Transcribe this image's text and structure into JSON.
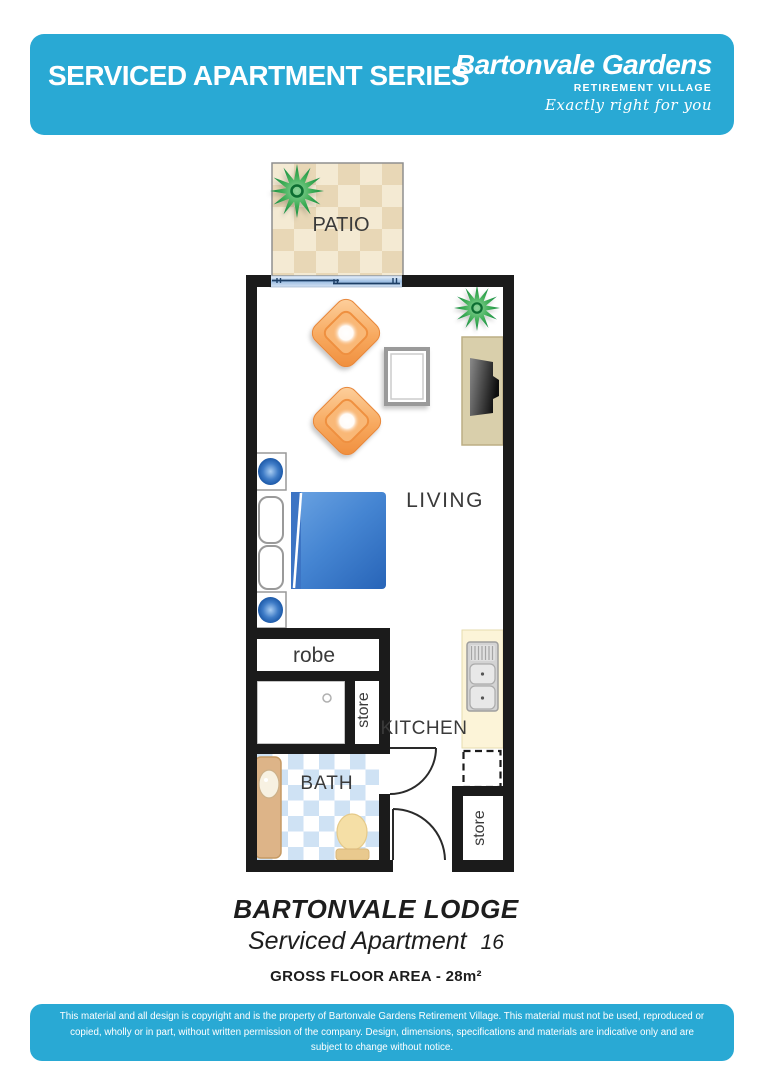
{
  "header": {
    "title": "SERVICED APARTMENT SERIES",
    "brand": "Bartonvale Gardens",
    "brand_sub": "RETIREMENT VILLAGE",
    "tagline": "Exactly right for you"
  },
  "plan": {
    "labels": {
      "patio": "PATIO",
      "living": "LIVING",
      "robe": "robe",
      "store_upper": "store",
      "kitchen": "KITCHEN",
      "bath": "BATH",
      "store_lower": "store"
    },
    "icons": [
      "plant-icon",
      "sliding-door",
      "armchair-icon",
      "coffee-table-icon",
      "tv-cabinet-icon",
      "bedside-lamp-icon",
      "pillow-icon",
      "bed-icon",
      "kitchen-sink-icon",
      "appliance-provision-dashed",
      "vanity-basin-icon",
      "toilet-icon",
      "door-swing-arc"
    ],
    "colors": {
      "accent_blue": "#29a9d4",
      "wall": "#1b1b1b",
      "patio_tan": "#e8d7b6",
      "patio_cream": "#f4ead3",
      "bath_tile_blue": "#cfe2f4",
      "chair_orange": "#f5a055",
      "bed_blue": "#3d7fcb",
      "bench_cream": "#fcf4d8",
      "plant_green": "#1f9348"
    }
  },
  "titles": {
    "lodge": "BARTONVALE LODGE",
    "apartment": "Serviced Apartment",
    "apartment_number": "16",
    "floor_area": "GROSS FLOOR AREA - 28m²"
  },
  "footer": {
    "copyright": "This material and all design is copyright and is the property of Bartonvale Gardens Retirement Village. This material must not be used, reproduced or copied, wholly or in part, without written permission of the company. Design, dimensions, specifications and materials are indicative only and are subject to change without notice."
  }
}
